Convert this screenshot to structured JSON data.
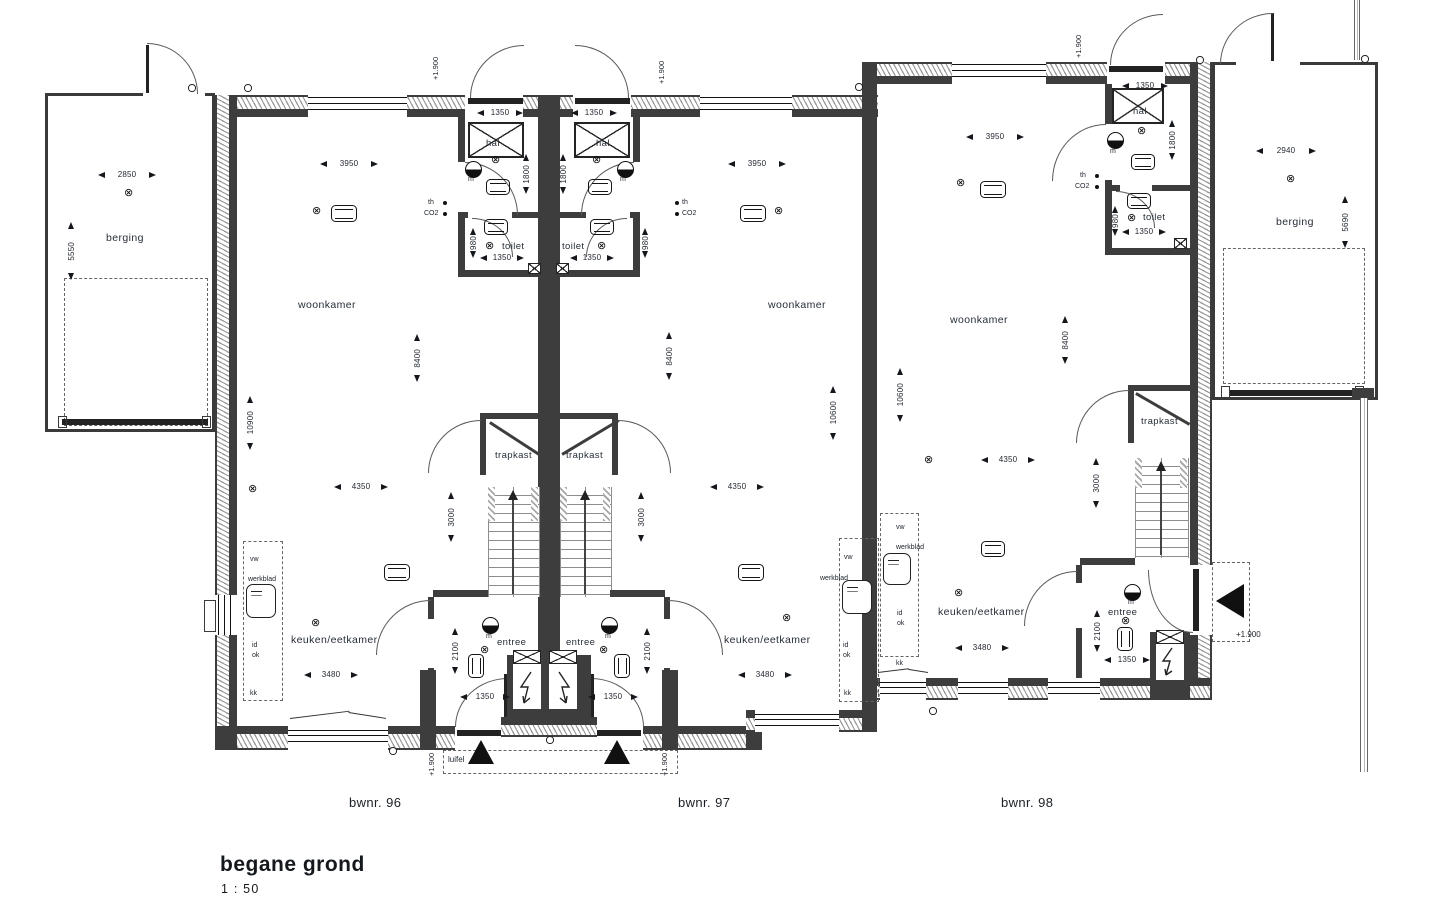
{
  "title": {
    "main": "begane grond",
    "scale": "1 : 50"
  },
  "units": {
    "u96": "bwnr. 96",
    "u97": "bwnr. 97",
    "u98": "bwnr. 98"
  },
  "rooms": {
    "berging": "berging",
    "woonkamer": "woonkamer",
    "hal": "hal",
    "toilet": "toilet",
    "trapkast": "trapkast",
    "entree": "entree",
    "keuken": "keuken/eetkamer",
    "luifel": "luifel"
  },
  "dims": {
    "w3950": "3950",
    "h8400": "8400",
    "h10900": "10900",
    "h10600": "10600",
    "w4350": "4350",
    "w3480": "3480",
    "h3000": "3000",
    "h2100": "2100",
    "w1350": "1350",
    "h1800": "1800",
    "h980": "980",
    "w2850": "2850",
    "h5550": "5550",
    "w2940": "2940",
    "h5690": "5690",
    "level": "+1.900"
  },
  "fixtures": {
    "vw": "vw",
    "werkblad": "werkblad",
    "id": "id",
    "ok": "ok",
    "kk": "kk",
    "th": "th",
    "co2": "CO2",
    "mv": "m",
    "light": "⊗"
  }
}
